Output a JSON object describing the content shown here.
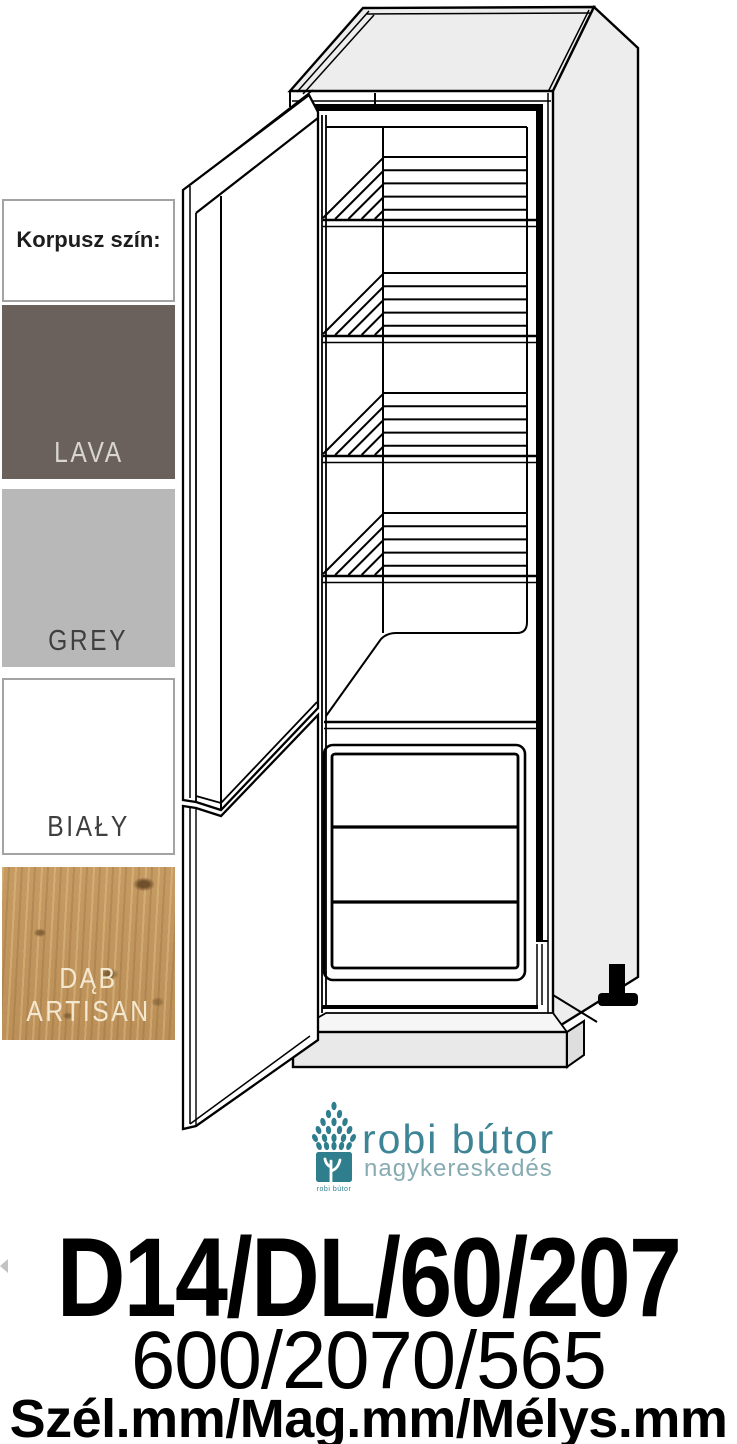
{
  "swatch_panel": {
    "header": "Korpusz szín:",
    "swatches": [
      {
        "name": "lava",
        "label": "LAVA",
        "color": "#6a615c",
        "text_color": "#d8d5d2"
      },
      {
        "name": "grey",
        "label": "GREY",
        "color": "#b8b8b8",
        "text_color": "#3f3f3f"
      },
      {
        "name": "bialy",
        "label": "BIAŁY",
        "color": "#ffffff",
        "text_color": "#3f3f3f"
      },
      {
        "name": "dab-artisan",
        "label": "DĄB ARTISAN",
        "color": "#c59a61",
        "text_color": "#f3e8cf"
      }
    ]
  },
  "logo": {
    "brand": "robi bútor",
    "subtitle": "nagykereskedés",
    "badge_label": "robi bútor",
    "teal": "#2e7e8e",
    "brand_color": "#3d8496",
    "subtitle_color": "#87abb3"
  },
  "product": {
    "code": "D14/DL/60/207",
    "dimensions": "600/2070/565",
    "dimensions_label": "Szél.mm/Mag.mm/Mélys.mm"
  }
}
